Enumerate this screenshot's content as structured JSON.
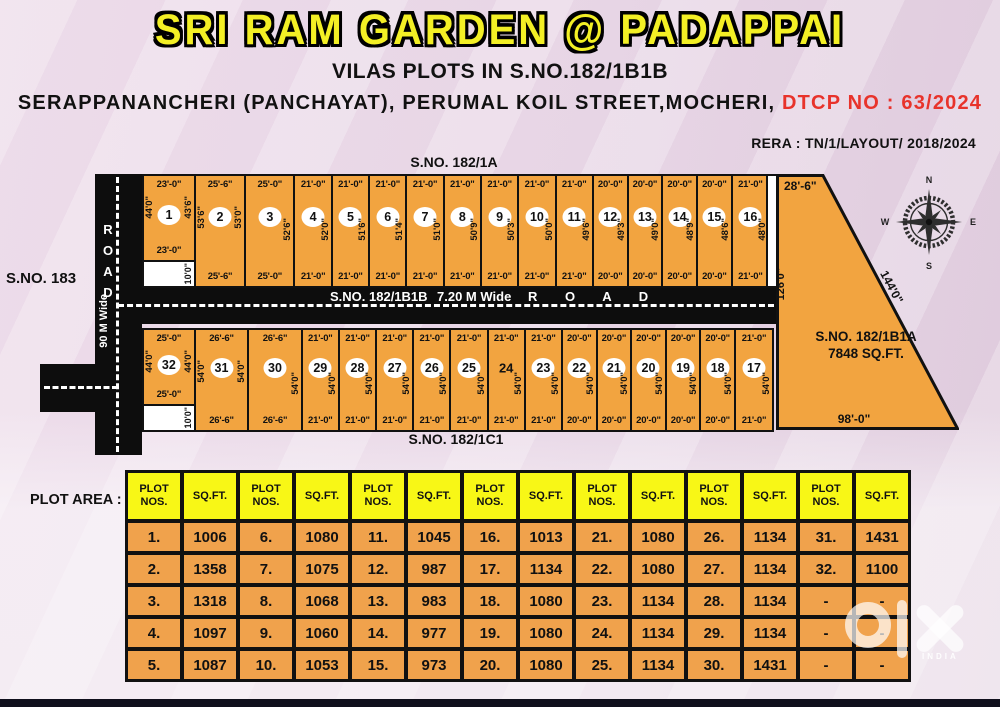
{
  "header": {
    "title": "SRI RAM GARDEN @ PADAPPAI",
    "subtitle": "VILAS PLOTS IN S.NO.182/1B1B",
    "address": "SERAPPANANCHERI (PANCHAYAT), PERUMAL KOIL STREET,MOCHERI,",
    "dtcp": "DTCP NO : 63/2024",
    "rera": "RERA : TN/1/LAYOUT/ 2018/2024"
  },
  "colors": {
    "title_yellow": "#f3ef25",
    "dtcp_red": "#e8332b",
    "plot_orange": "#f2a440",
    "table_header_yellow": "#f8f716",
    "table_cell_orange": "#f0a24c",
    "road_black": "#0d0d0d"
  },
  "site_plan": {
    "north_boundary": "S.NO. 182/1A",
    "west_boundary": "S.NO. 183",
    "south_boundary": "S.NO. 182/1C1",
    "left_road": {
      "letters": [
        "R",
        "O",
        "A",
        "D"
      ],
      "width_label": "90 M Wide"
    },
    "main_road": {
      "survey": "S.NO. 182/1B1B",
      "width_label": "7.20 M Wide",
      "name": "R O A D"
    },
    "east_parcel": {
      "survey": "S.NO. 182/1B1A",
      "area": "7848 SQ.FT.",
      "top_dim": "28'-6\"",
      "left_dim": "126'0\"",
      "diagonal_dim": "144'0\"",
      "bottom_dim": "98'-0\""
    },
    "compass": {
      "n": "N",
      "e": "E",
      "s": "S",
      "w": "W"
    },
    "top_row": [
      {
        "no": "1",
        "t": "23'-0\"",
        "l": "44'0\"",
        "r": "43'6\"",
        "b": "23'-0\"",
        "n": "10'0\"",
        "w": 58
      },
      {
        "no": "2",
        "t": "25'-6\"",
        "l": "53'6\"",
        "r": "53'0\"",
        "b": "25'-6\"",
        "w": 56
      },
      {
        "no": "3",
        "t": "25'-0\"",
        "r": "52'6\"",
        "b": "25'-0\"",
        "w": 55
      },
      {
        "no": "4",
        "t": "21'-0\"",
        "r": "52'0\"",
        "b": "21'-0\"",
        "w": 41
      },
      {
        "no": "5",
        "t": "21'-0\"",
        "r": "51'6\"",
        "b": "21'-0\"",
        "w": 41
      },
      {
        "no": "6",
        "t": "21'-0\"",
        "r": "51'4\"",
        "b": "21'-0\"",
        "w": 41
      },
      {
        "no": "7",
        "t": "21'-0\"",
        "r": "51'0\"",
        "b": "21'-0\"",
        "w": 41
      },
      {
        "no": "8",
        "t": "21'-0\"",
        "r": "50'9\"",
        "b": "21'-0\"",
        "w": 41
      },
      {
        "no": "9",
        "t": "21'-0\"",
        "r": "50'3\"",
        "b": "21'-0\"",
        "w": 41
      },
      {
        "no": "10",
        "t": "21'-0\"",
        "r": "50'0\"",
        "b": "21'-0\"",
        "w": 41
      },
      {
        "no": "11",
        "t": "21'-0\"",
        "r": "49'6\"",
        "b": "21'-0\"",
        "w": 41
      },
      {
        "no": "12",
        "t": "20'-0\"",
        "r": "49'3\"",
        "b": "20'-0\"",
        "w": 38
      },
      {
        "no": "13",
        "t": "20'-0\"",
        "r": "49'0\"",
        "b": "20'-0\"",
        "w": 38
      },
      {
        "no": "14",
        "t": "20'-0\"",
        "r": "48'9\"",
        "b": "20'-0\"",
        "w": 38
      },
      {
        "no": "15",
        "t": "20'-0\"",
        "r": "48'6\"",
        "b": "20'-0\"",
        "w": 38
      },
      {
        "no": "16",
        "t": "21'-0\"",
        "r": "48'0\"",
        "b": "21'-0\"",
        "w": 41
      }
    ],
    "bottom_row": [
      {
        "no": "32",
        "t": "25'-0\"",
        "l": "44'0\"",
        "r": "44'0\"",
        "b": "25'-0\"",
        "n": "10'0\"",
        "w": 58
      },
      {
        "no": "31",
        "t": "26'-6\"",
        "l": "54'0\"",
        "r": "54'0\"",
        "b": "26'-6\"",
        "w": 60
      },
      {
        "no": "30",
        "t": "26'-6\"",
        "r": "54'0\"",
        "b": "26'-6\"",
        "w": 60
      },
      {
        "no": "29",
        "t": "21'-0\"",
        "r": "54'0\"",
        "b": "21'-0\"",
        "w": 41
      },
      {
        "no": "28",
        "t": "21'-0\"",
        "r": "54'0\"",
        "b": "21'-0\"",
        "w": 41
      },
      {
        "no": "27",
        "t": "21'-0\"",
        "r": "54'0\"",
        "b": "21'-0\"",
        "w": 41
      },
      {
        "no": "26",
        "t": "21'-0\"",
        "r": "54'0\"",
        "b": "21'-0\"",
        "w": 41
      },
      {
        "no": "25",
        "t": "21'-0\"",
        "r": "54'0\"",
        "b": "21'-0\"",
        "w": 41
      },
      {
        "no": "24",
        "circle": false,
        "t": "21'-0\"",
        "r": "54'0\"",
        "b": "21'-0\"",
        "w": 41
      },
      {
        "no": "23",
        "t": "21'-0\"",
        "r": "54'0\"",
        "b": "21'-0\"",
        "w": 41
      },
      {
        "no": "22",
        "t": "20'-0\"",
        "r": "54'0\"",
        "b": "20'-0\"",
        "w": 38
      },
      {
        "no": "21",
        "t": "20'-0\"",
        "r": "54'0\"",
        "b": "20'-0\"",
        "w": 38
      },
      {
        "no": "20",
        "t": "20'-0\"",
        "r": "54'0\"",
        "b": "20'-0\"",
        "w": 38
      },
      {
        "no": "19",
        "t": "20'-0\"",
        "r": "54'0\"",
        "b": "20'-0\"",
        "w": 38
      },
      {
        "no": "18",
        "t": "20'-0\"",
        "r": "54'0\"",
        "b": "20'-0\"",
        "w": 38
      },
      {
        "no": "17",
        "t": "21'-0\"",
        "r": "54'0\"",
        "b": "21'-0\"",
        "w": 42
      }
    ]
  },
  "table": {
    "label": "PLOT AREA :",
    "col_headers": [
      "PLOT NOS.",
      "SQ.FT."
    ],
    "rows": [
      [
        [
          "1.",
          "1006"
        ],
        [
          "6.",
          "1080"
        ],
        [
          "11.",
          "1045"
        ],
        [
          "16.",
          "1013"
        ],
        [
          "21.",
          "1080"
        ],
        [
          "26.",
          "1134"
        ],
        [
          "31.",
          "1431"
        ]
      ],
      [
        [
          "2.",
          "1358"
        ],
        [
          "7.",
          "1075"
        ],
        [
          "12.",
          "987"
        ],
        [
          "17.",
          "1134"
        ],
        [
          "22.",
          "1080"
        ],
        [
          "27.",
          "1134"
        ],
        [
          "32.",
          "1100"
        ]
      ],
      [
        [
          "3.",
          "1318"
        ],
        [
          "8.",
          "1068"
        ],
        [
          "13.",
          "983"
        ],
        [
          "18.",
          "1080"
        ],
        [
          "23.",
          "1134"
        ],
        [
          "28.",
          "1134"
        ],
        [
          "-",
          "-"
        ]
      ],
      [
        [
          "4.",
          "1097"
        ],
        [
          "9.",
          "1060"
        ],
        [
          "14.",
          "977"
        ],
        [
          "19.",
          "1080"
        ],
        [
          "24.",
          "1134"
        ],
        [
          "29.",
          "1134"
        ],
        [
          "-",
          "-"
        ]
      ],
      [
        [
          "5.",
          "1087"
        ],
        [
          "10.",
          "1053"
        ],
        [
          "15.",
          "973"
        ],
        [
          "20.",
          "1080"
        ],
        [
          "25.",
          "1134"
        ],
        [
          "30.",
          "1431"
        ],
        [
          "-",
          "-"
        ]
      ]
    ]
  },
  "watermark": {
    "brand": "olx",
    "caption": "INDIA"
  }
}
